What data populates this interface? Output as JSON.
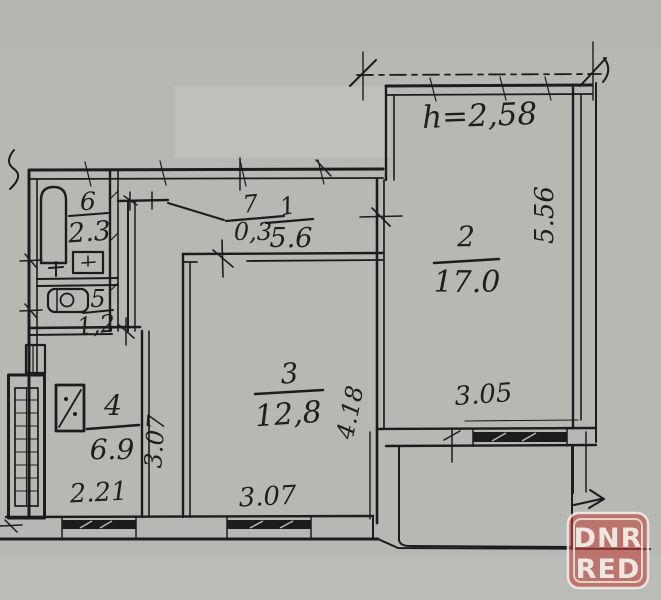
{
  "document": {
    "kind_label": "apartment floor plan (scanned, hand-drawn)",
    "paper_color": "#b7b8b4",
    "ink_color": "#1c1c1c"
  },
  "plan": {
    "ceiling_height": "h=2,58",
    "rooms": {
      "room1": {
        "number": "1",
        "area": "5.6"
      },
      "room2": {
        "number": "2",
        "area": "17.0"
      },
      "room3": {
        "number": "3",
        "area": "12,8"
      },
      "room4": {
        "number": "4",
        "area": "6.9"
      },
      "room5": {
        "number": "5",
        "area": "1,2"
      },
      "room6": {
        "number": "6",
        "area": "2.3"
      },
      "room7": {
        "number": "7",
        "area": "0,3"
      }
    },
    "dimensions": {
      "room2_depth": "5.56",
      "room2_width": "3.05",
      "room3_depth": "4.18",
      "room3_width": "3.07",
      "kitchen_depth": "3.07",
      "kitchen_width": "2.21"
    }
  },
  "watermark": {
    "line1": "DNR",
    "line2": "RED",
    "badge_color": "#c0443a"
  }
}
